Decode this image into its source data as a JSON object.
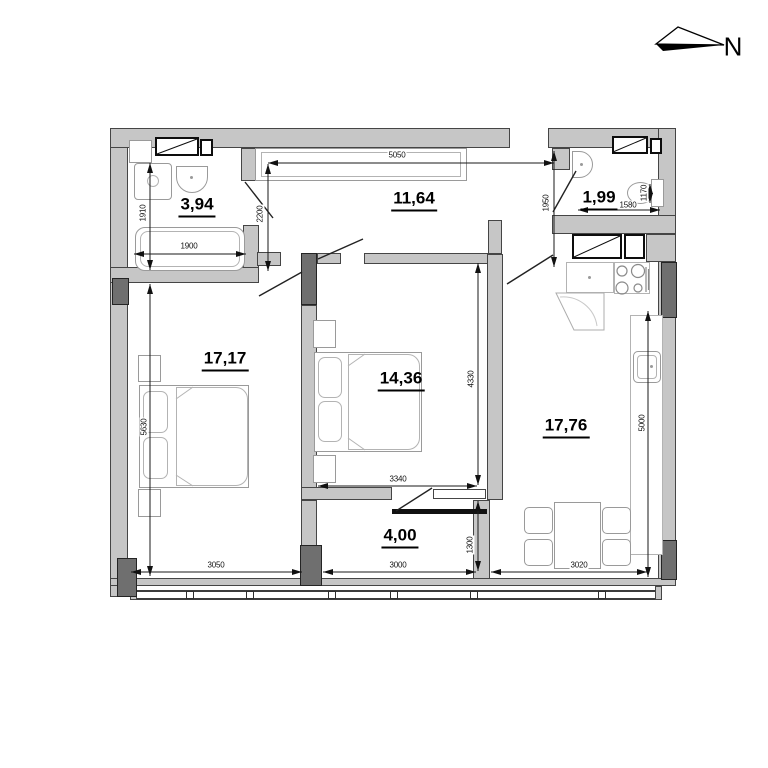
{
  "compass": {
    "label": "N"
  },
  "areas": {
    "bathroom": "3,94",
    "hallway": "11,64",
    "wc": "1,99",
    "bedroom1": "17,17",
    "bedroom2": "14,36",
    "kitchen": "17,76",
    "loggia": "4,00"
  },
  "dims": {
    "d5050": "5050",
    "d2200": "2200",
    "d1950": "1950",
    "d1910": "1910",
    "d1900": "1900",
    "d1580": "1580",
    "d1170": "1170",
    "d5630": "5630",
    "d3050": "3050",
    "d3000": "3000",
    "d3020": "3020",
    "d3340": "3340",
    "d4330": "4330",
    "d1300": "1300",
    "d5000": "5000"
  }
}
